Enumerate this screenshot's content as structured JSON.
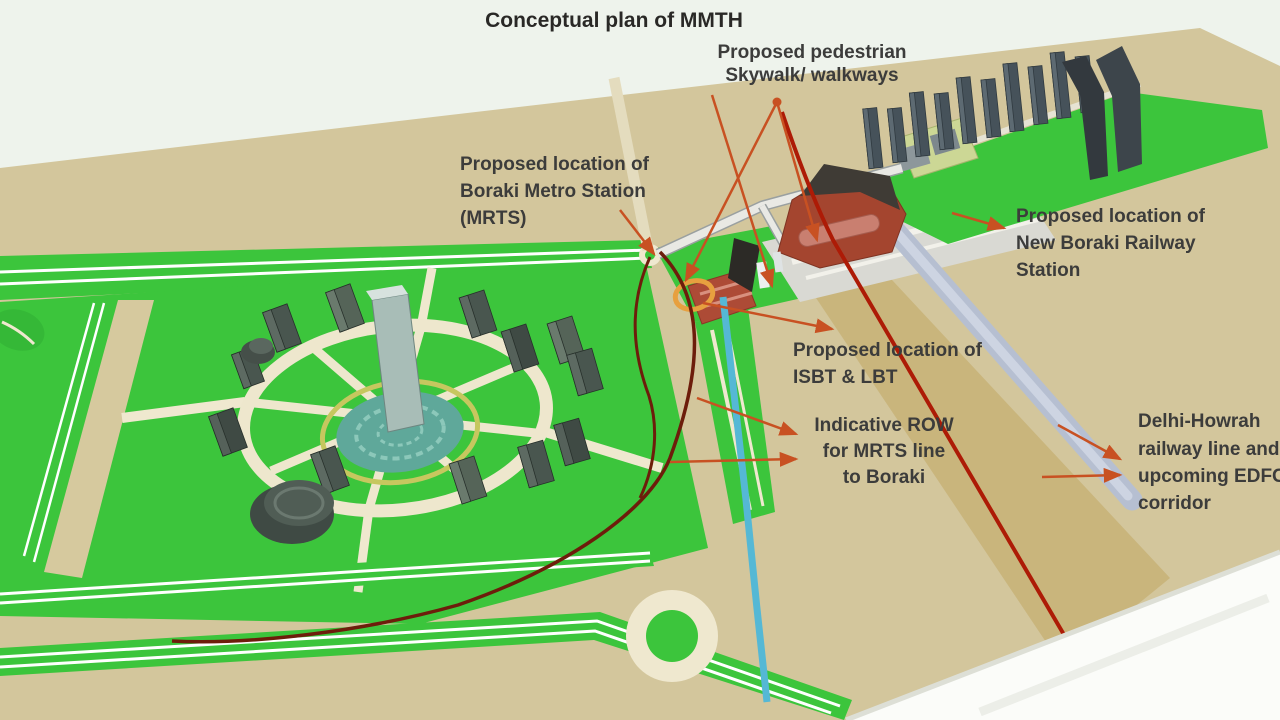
{
  "title": "Conceptual plan of MMTH",
  "labels": {
    "skywalk": {
      "lines": [
        "Proposed pedestrian",
        "Skywalk/ walkways"
      ]
    },
    "metro_station": {
      "lines": [
        "Proposed location of",
        "Boraki Metro Station",
        "(MRTS)"
      ]
    },
    "railway_station": {
      "lines": [
        "Proposed location of",
        "New Boraki Railway",
        "Station"
      ]
    },
    "isbt": {
      "lines": [
        "Proposed location of",
        "ISBT & LBT"
      ]
    },
    "row": {
      "lines": [
        "Indicative ROW",
        "for MRTS line",
        "to Boraki"
      ]
    },
    "delhi_howrah": {
      "lines": [
        "Delhi-Howrah",
        "railway line and",
        "upcoming EDFC",
        "corridor"
      ]
    }
  },
  "features": [
    "central-business-district-park-with-circular-tower-cluster",
    "central-fountain-pool",
    "boraki-metro-station-site",
    "new-boraki-railway-station-building",
    "pedestrian-skywalk",
    "isbt-lbt-site",
    "mrts-row-corridor-lines",
    "mrts-red-alignment-line",
    "canal-cyan-line",
    "delhi-howrah-railway-edfc-corridor",
    "tower-row-north-east",
    "roundabout-south",
    "annotation-leader-arrows"
  ],
  "colors": {
    "sky": "#eef3ec",
    "ground_tan": "#d3c69c",
    "ground_tan_dark": "#c8b379",
    "park_green": "#3cc53c",
    "road_cream": "#efe8cf",
    "rail_band": "#b6bfd1",
    "station_red": "#a4452f",
    "station_rose": "#c97f70",
    "tower_dark": "#46525a",
    "pool_teal": "#5fa89a",
    "ring_yellow": "#c6c75f",
    "cyan_line": "#55b8d5",
    "red_line": "#ad1b06",
    "row_dark_red": "#6d1d0b",
    "leader_orange": "#c85122",
    "highlight_orange": "#e7a03f",
    "label_text": "#3c3c3b"
  }
}
